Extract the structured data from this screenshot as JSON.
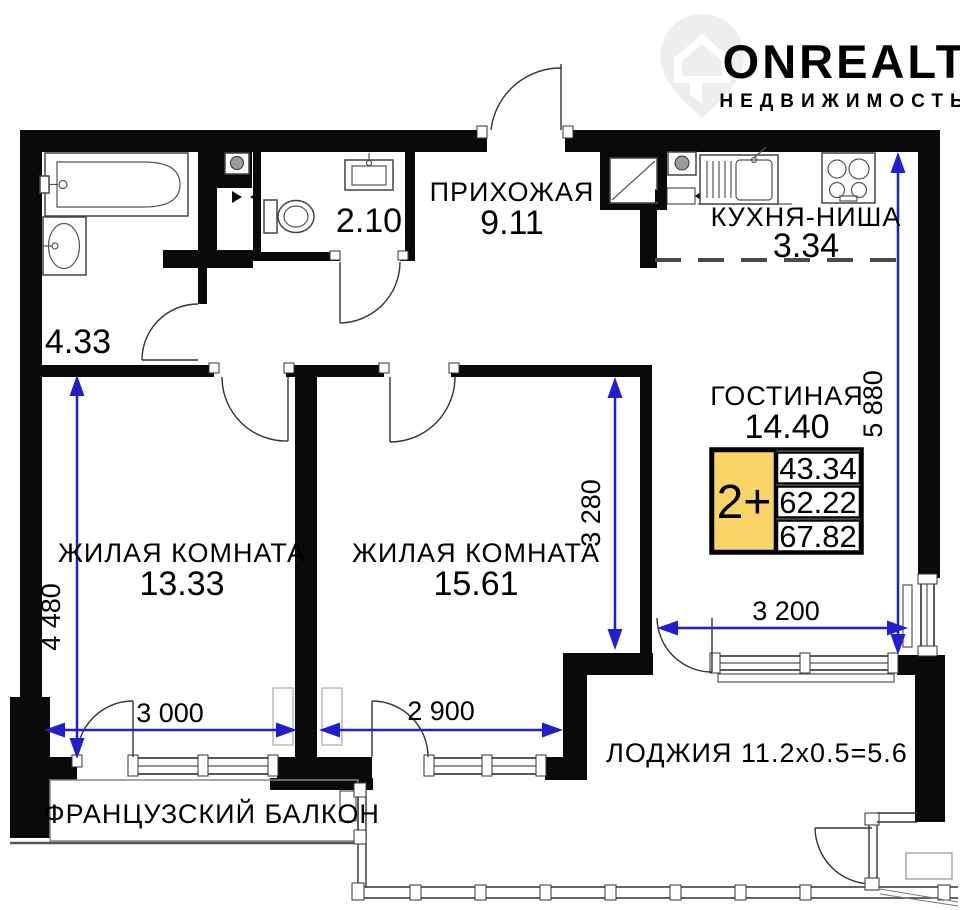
{
  "watermark": {
    "brand": "ONREALT",
    "subtitle": "НЕДВИЖИМОСТЬ",
    "icon": "map-pin-house-icon"
  },
  "plan": {
    "rooms": {
      "corridor": {
        "area": "4.33"
      },
      "hallway": {
        "name": "ПРИХОЖАЯ",
        "area": "9.11"
      },
      "wc": {
        "area": "2.10"
      },
      "kitchen": {
        "name": "КУХНЯ-НИША",
        "area": "3.34"
      },
      "living_room": {
        "name": "ГОСТИНАЯ",
        "area": "14.40"
      },
      "bedroom_left": {
        "name": "ЖИЛАЯ КОМНАТА",
        "area": "13.33"
      },
      "bedroom_middle": {
        "name": "ЖИЛАЯ КОМНАТА",
        "area": "15.61"
      },
      "loggia": {
        "label": "ЛОДЖИЯ 11.2x0.5=5.6"
      },
      "french_balcony": {
        "label": "ФРАНЦУЗСКИЙ БАЛКОН"
      }
    },
    "dimensions": {
      "left_vertical": "4 480",
      "bottom_left": "3 000",
      "bottom_middle": "2 900",
      "middle_vertical": "3 280",
      "right_vertical": "5 880",
      "loggia_horizontal": "3 200"
    },
    "info_box": {
      "rooms_badge": "2+",
      "values": [
        "43.34",
        "62.22",
        "67.82"
      ]
    }
  },
  "colors": {
    "dimension_blue": "#1f1fce",
    "wall_black": "#0a0a0a",
    "info_box_yellow": "#f8d469",
    "watermark_gray": "#eeeeee"
  }
}
